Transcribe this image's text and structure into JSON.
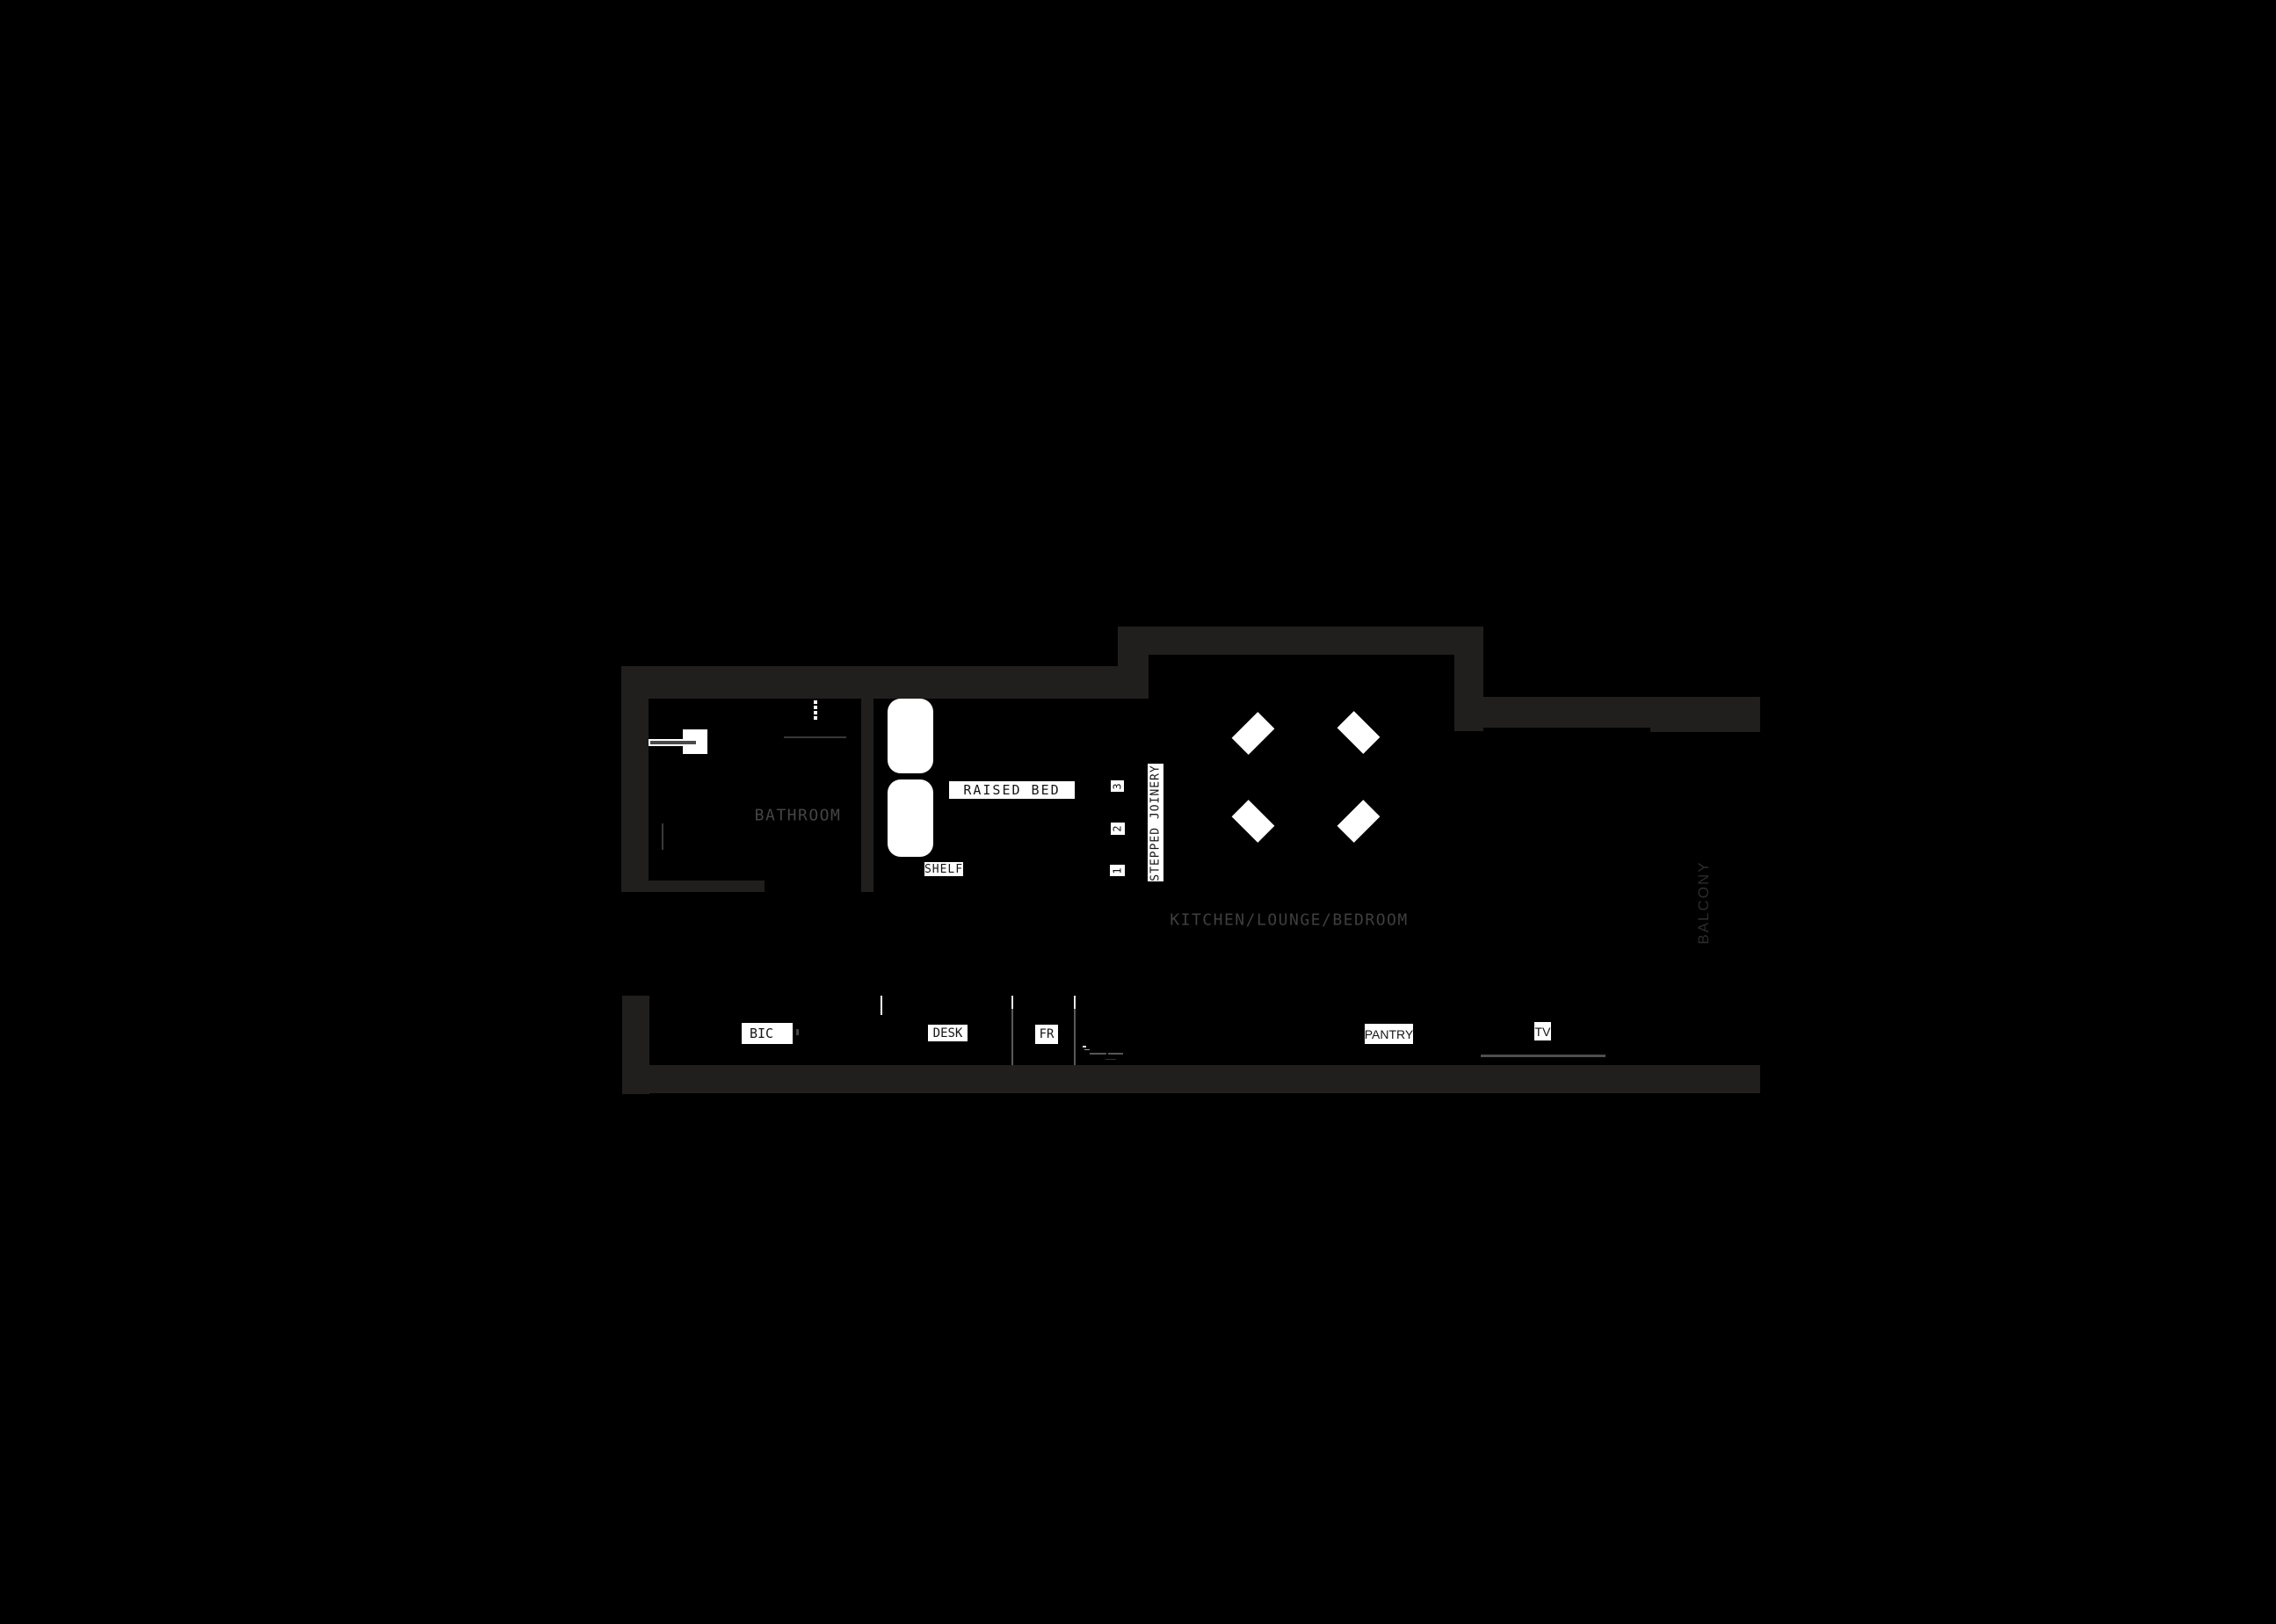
{
  "plan": {
    "rooms": {
      "bathroom": "BATHROOM",
      "kitchen_lounge_bedroom": "KITCHEN/LOUNGE/BEDROOM",
      "balcony": "BALCONY"
    },
    "labels": {
      "raised_bed": "RAISED BED",
      "shelf": "SHELF",
      "stepped_joinery": "STEPPED JOINERY",
      "bic": "BIC",
      "desk": "DESK",
      "fridge": "FR",
      "pantry": "PANTRY",
      "tv": "TV"
    },
    "steps": [
      "1",
      "2",
      "3"
    ],
    "colors": {
      "background": "#000000",
      "wall": "#211f1e",
      "label_bg": "#ffffff",
      "label_text": "#161616",
      "room_text": "#454545",
      "balcony_text": "#2c2c2c",
      "furniture": "#ffffff",
      "thin_line": "#5a5a5a"
    }
  }
}
